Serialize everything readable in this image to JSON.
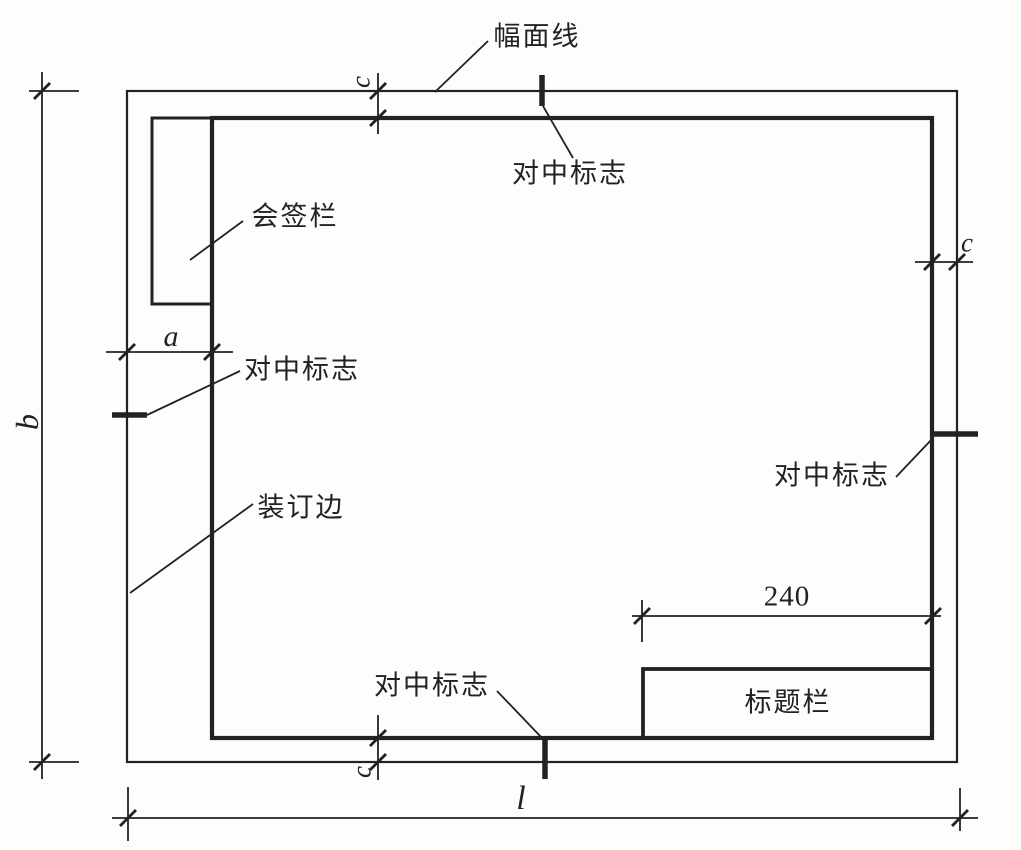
{
  "labels": {
    "sheet_boundary_line": "幅面线",
    "centering_mark_top": "对中标志",
    "signature_block": "会签栏",
    "centering_mark_left": "对中标志",
    "binding_edge": "装订边",
    "centering_mark_right": "对中标志",
    "centering_mark_bottom": "对中标志",
    "title_block": "标题栏"
  },
  "dimensions": {
    "binding_margin_a": "a",
    "sheet_height_b": "b",
    "margin_top_c": "c",
    "margin_right_c": "c",
    "margin_bottom_c": "c",
    "sheet_length_l": "l",
    "title_block_width": "240"
  },
  "colors": {
    "line": "#222222",
    "background": "#fdfdfc"
  }
}
